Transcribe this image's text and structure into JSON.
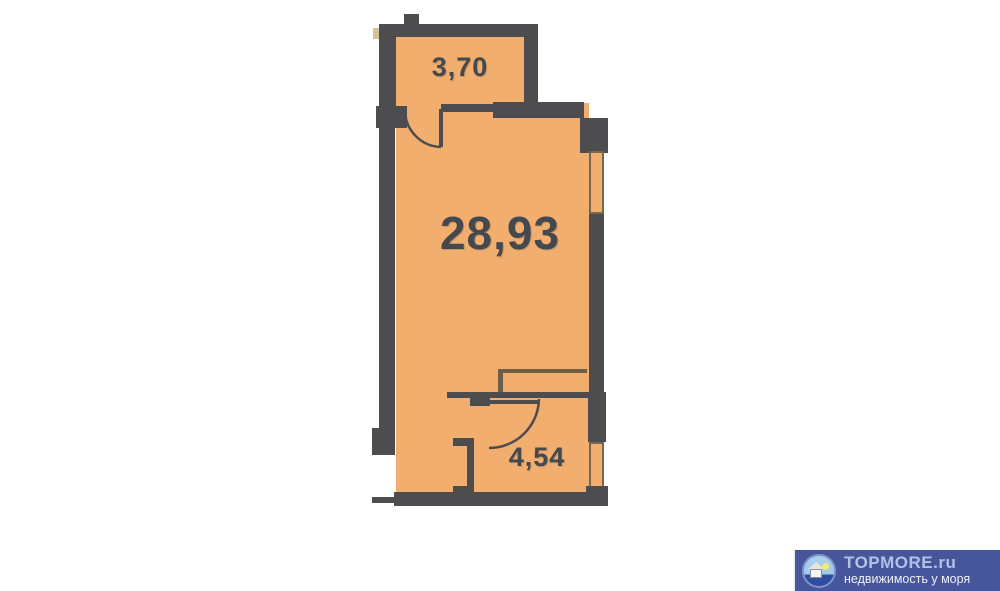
{
  "plan": {
    "type": "apartment-floor-plan",
    "rooms": [
      {
        "id": "balcony",
        "area_label": "3,70"
      },
      {
        "id": "living-room",
        "area_label": "28,93"
      },
      {
        "id": "bathroom",
        "area_label": "4,54"
      }
    ],
    "colors": {
      "room_fill": "#F2AE6E",
      "wall": "#4D4D50",
      "label_text": "#44484F",
      "window_border": "#76684E",
      "thin_partition_line": "#6E5F46"
    }
  },
  "watermark": {
    "brand": "TOPMORE.ru",
    "tagline": "недвижимость у моря",
    "icon": "house-by-sea-icon",
    "colors": {
      "background": "#47569B",
      "brand_text": "#B4C0E6",
      "tagline_text": "#EDEFF8"
    }
  }
}
